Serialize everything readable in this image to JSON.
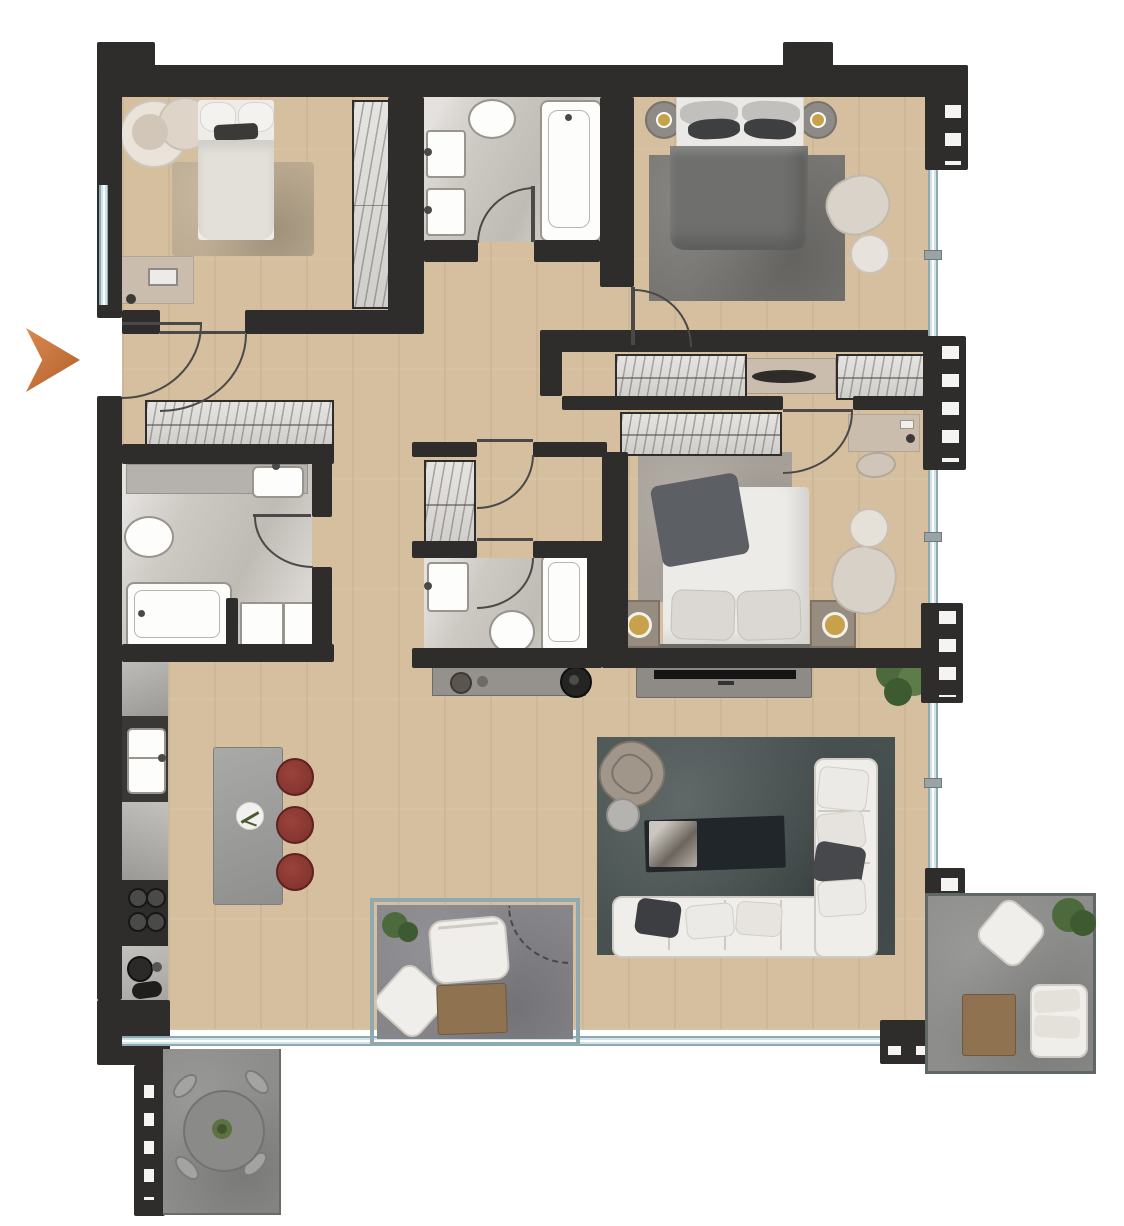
{
  "title": "apartment-floor-plan",
  "entrance": {
    "marker": "entry-direction-arrow",
    "color": "#c06f38"
  },
  "colors": {
    "wall": "#2e2d2b",
    "door": "#4a4947",
    "wood": "#d5bf9f",
    "bath": "#cdc9c3",
    "balcony": "#8d8d8b",
    "loggia": "#86868a",
    "glass": "#cfe3e8",
    "glassFrame": "#8fa9b1",
    "white": "#f0eeea",
    "whiteEdge": "#cfcbc4",
    "wardrobe": "#dcdbd7",
    "beige": "#cbbdae",
    "rugBeige": "#bdac92",
    "rugDark": "#787672",
    "rugGray": "#a59f97",
    "rugTeal": "#47514f",
    "island": "#9d9d9b",
    "stool": "#8c3731",
    "counter": "#a8a6a2",
    "darkUnit": "#393836",
    "tv": "#151515",
    "plantDark": "#3e5a31",
    "plantMid": "#4d6a3d",
    "plantLight": "#5e7c49",
    "accent": "#c06f38",
    "gold": "#c8a24a",
    "tableBrown": "#8f7350",
    "bowl": "#2e2b28"
  },
  "rooms": [
    {
      "name": "bedroom-1",
      "furniture": [
        "double-bed",
        "armchair-pair",
        "rug",
        "desk",
        "wardrobe",
        "window"
      ]
    },
    {
      "name": "bathroom-1",
      "furniture": [
        "bathtub",
        "double-washbasin",
        "toilet"
      ]
    },
    {
      "name": "master-bedroom",
      "furniture": [
        "double-bed",
        "round-nightstand-lamp-left",
        "round-nightstand-lamp-right",
        "rug",
        "armchair",
        "ottoman"
      ]
    },
    {
      "name": "dressing-corridor",
      "furniture": [
        "wardrobe-row-left",
        "console-with-bowl",
        "wardrobe-row-right"
      ]
    },
    {
      "name": "bedroom-2",
      "furniture": [
        "double-bed",
        "nightstand-lamp-left",
        "nightstand-lamp-right",
        "rug",
        "armchair",
        "ottoman",
        "desk",
        "desk-chair",
        "wardrobe"
      ]
    },
    {
      "name": "walk-in-closet",
      "furniture": [
        "wardrobe"
      ]
    },
    {
      "name": "bathroom-2",
      "furniture": [
        "bathtub",
        "washbasin-counter",
        "toilet",
        "washer",
        "dryer"
      ]
    },
    {
      "name": "bathroom-3",
      "furniture": [
        "bathtub",
        "washbasin",
        "toilet"
      ]
    },
    {
      "name": "hallway",
      "furniture": [
        "sideboard-wardrobe"
      ]
    },
    {
      "name": "kitchen",
      "furniture": [
        "counter-run",
        "sink",
        "cooktop",
        "coffee-station",
        "island",
        "stool-1",
        "stool-2",
        "stool-3"
      ]
    },
    {
      "name": "living-room",
      "furniture": [
        "l-shaped-sofa",
        "pillows",
        "coffee-table",
        "marble-tray",
        "armchair",
        "side-table",
        "tv-console",
        "tv",
        "sideboard",
        "speaker",
        "plant"
      ]
    },
    {
      "name": "loggia-balcony",
      "furniture": [
        "outdoor-sofa",
        "outdoor-chair",
        "coffee-table",
        "plant"
      ]
    },
    {
      "name": "terrace-bottom-left",
      "furniture": [
        "round-dining-table",
        "chair-1",
        "chair-2",
        "chair-3",
        "chair-4",
        "plant"
      ]
    },
    {
      "name": "terrace-right",
      "furniture": [
        "outdoor-chair",
        "outdoor-loveseat",
        "coffee-table",
        "plant"
      ]
    }
  ],
  "architecture": {
    "walls": "dark-charcoal",
    "windows": "light-blue-glass",
    "doors": "arc-swing",
    "facade_units": "slatted-dark-panels"
  }
}
